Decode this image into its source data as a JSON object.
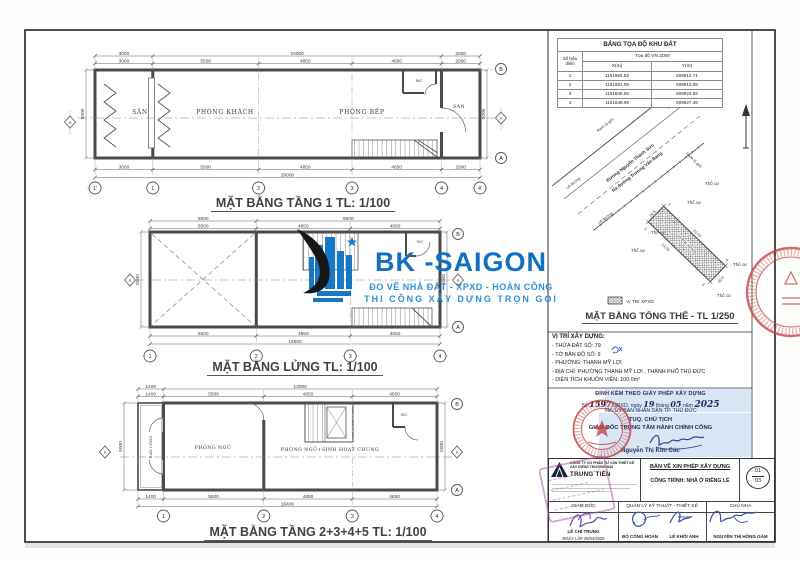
{
  "logo": {
    "name": "BK -SAIGON",
    "tagline1": "ĐO VẼ NHÀ ĐẤT - XPXD - HOÀN CÔNG",
    "tagline2": "THI CÔNG XÂY DỰNG TRỌN GÓI"
  },
  "coord_table": {
    "title": "BẢNG TỌA ĐỘ KHU ĐẤT",
    "system": "Tọa độ VN 2000",
    "col_point": "Số hiệu điểm",
    "col_x": "X(m)",
    "col_y": "Y(m)",
    "rows": [
      {
        "id": "1",
        "x": "1191864.53",
        "y": "609913.71"
      },
      {
        "id": "2",
        "x": "1191861.09",
        "y": "609910.08"
      },
      {
        "id": "3",
        "x": "1191846.55",
        "y": "609923.82"
      },
      {
        "id": "4",
        "x": "1191849.99",
        "y": "609927.45"
      }
    ]
  },
  "site_plan": {
    "title": "MẶT BẰNG TỔNG THỂ - TL 1/250",
    "legend_label": "VỊ TRÍ XPXD",
    "plot_label": "VỊ TRÍ XPXD",
    "road_name1": "Đường Nguyễn Thanh Sơn",
    "road_name2": "Ra đường Trương Văn Bang",
    "road_edge": "Lề đường",
    "boundary": "Ranh lộ giới",
    "land_label": "Thổ cư",
    "dim_20": "20.00",
    "dim_5": "5.00",
    "dim_2": "2.00",
    "dim_13": "13.00",
    "corners": [
      "1",
      "2",
      "3",
      "4"
    ]
  },
  "location_info": {
    "title": "VỊ TRÍ XÂY DỰNG:",
    "lines": [
      "- THỬA ĐẤT SỐ: 79",
      "- TỜ BẢN ĐỒ SỐ: 9",
      "- PHƯỜNG: THẠNH MỸ LỢI",
      "- ĐỊA CHỈ: PHƯỜNG THẠNH MỸ LỢI , THÀNH PHỐ THỦ ĐỨC",
      "- DIỆN TÍCH KHUÔN VIÊN: 100.0m²"
    ]
  },
  "permit": {
    "line1": "ĐÍNH KÈM THEO GIẤY PHÉP XÂY DỰNG",
    "seg_so": "Số",
    "number": "1597",
    "seg_gpxd": "/GPXD, ngày",
    "day": "19",
    "seg_thang": "tháng",
    "month": "05",
    "seg_nam": "năm",
    "year": "2025",
    "line3": "TM. ỦY BAN NHÂN DÂN TP. THỦ ĐỨC",
    "line4": "TUQ. CHỦ TỊCH",
    "line5": "GIÁM ĐỐC TRUNG TÂM HÀNH CHÍNH CÔNG",
    "signer": "Nguyễn Thị Kim Cúc"
  },
  "title_block": {
    "company_prefix": "CÔNG TY CỔ PHẦN TƯ VẤN THIẾT KẾ",
    "company_prefix2": "XÂY DỰNG THƯƠNG MẠI",
    "company_name": "TRUNG TIẾN",
    "doc_type": "BẢN VẼ XIN PHÉP XÂY DỰNG",
    "project": "CÔNG TRÌNH: NHÀ Ở RIÊNG LẺ",
    "sheet_no": "01",
    "sheet_total": "03",
    "role_director": "GIÁM ĐỐC",
    "role_tech": "QUẢN LÝ KỸ THUẬT - THIẾT KẾ",
    "role_owner": "CHỦ NHÀ",
    "director_name": "LÊ CHÍ TRUNG",
    "date_created": "NGÀY LẬP 28/04/2025",
    "tech_name1": "ĐỖ CÔNG HOAN",
    "tech_name2": "LÊ KHÔI ANH",
    "owner_name": "NGUYỄN THỊ HỒNG GẤM"
  },
  "plans": {
    "plan1": {
      "title": "MẶT BẰNG TẦNG 1 TL: 1/100",
      "rooms": {
        "san_front": "SÂN",
        "living": "PHÒNG KHÁCH",
        "kitchen": "PHÒNG BẾP",
        "wc": "WC",
        "san_rear": "SÂN"
      },
      "dims_top1": [
        "3000",
        "15000",
        "2000"
      ],
      "dims_top2": [
        "3000",
        "5500",
        "4850",
        "4650",
        "2000"
      ],
      "dims_bot1": [
        "3000",
        "5500",
        "4850",
        "4650",
        "2000"
      ],
      "total": "20000",
      "side": "5000",
      "grid": [
        "1'",
        "1",
        "2",
        "3",
        "4",
        "4'"
      ],
      "axis_b": "B",
      "axis_a": "A",
      "section": "A"
    },
    "plan2": {
      "title": "MẶT BẰNG LỬNG TL: 1/100",
      "rooms": {
        "wc": "WC"
      },
      "dims_top1": [
        "5500",
        "9500"
      ],
      "dims_top2": [
        "5500",
        "4850",
        "4650"
      ],
      "dims_bot1": [
        "5500",
        "4850",
        "4650"
      ],
      "total": "15000",
      "side": "5000",
      "grid": [
        "1",
        "2",
        "3",
        "4"
      ],
      "axis_b": "B",
      "axis_a": "A",
      "section": "A"
    },
    "plan3": {
      "title": "MẶT BẰNG TẦNG 2+3+4+5 TL: 1/100",
      "rooms": {
        "balcony": "BAN CÔNG",
        "bedroom": "PHÒNG NGỦ",
        "bedroom_living": "PHÒNG NGỦ+SINH HOẠT CHUNG",
        "wc": "WC"
      },
      "dims_top1": [
        "1400",
        "13000"
      ],
      "dims_top2": [
        "1400",
        "5500",
        "4850",
        "4650"
      ],
      "dims_bot1": [
        "1400",
        "5500",
        "4850",
        "4650"
      ],
      "total": "16400",
      "side": "5000",
      "grid": [
        "1",
        "2",
        "3",
        "4"
      ],
      "axis_b": "B",
      "axis_a": "A",
      "section": "A"
    }
  },
  "colors": {
    "logo_blue": "#1270c2",
    "logo_light_blue": "#2b91d4",
    "stamp_red": "#c23b3b",
    "signature_blue": "#3a4fb0",
    "highlight_blue": "#d8e6f6"
  }
}
